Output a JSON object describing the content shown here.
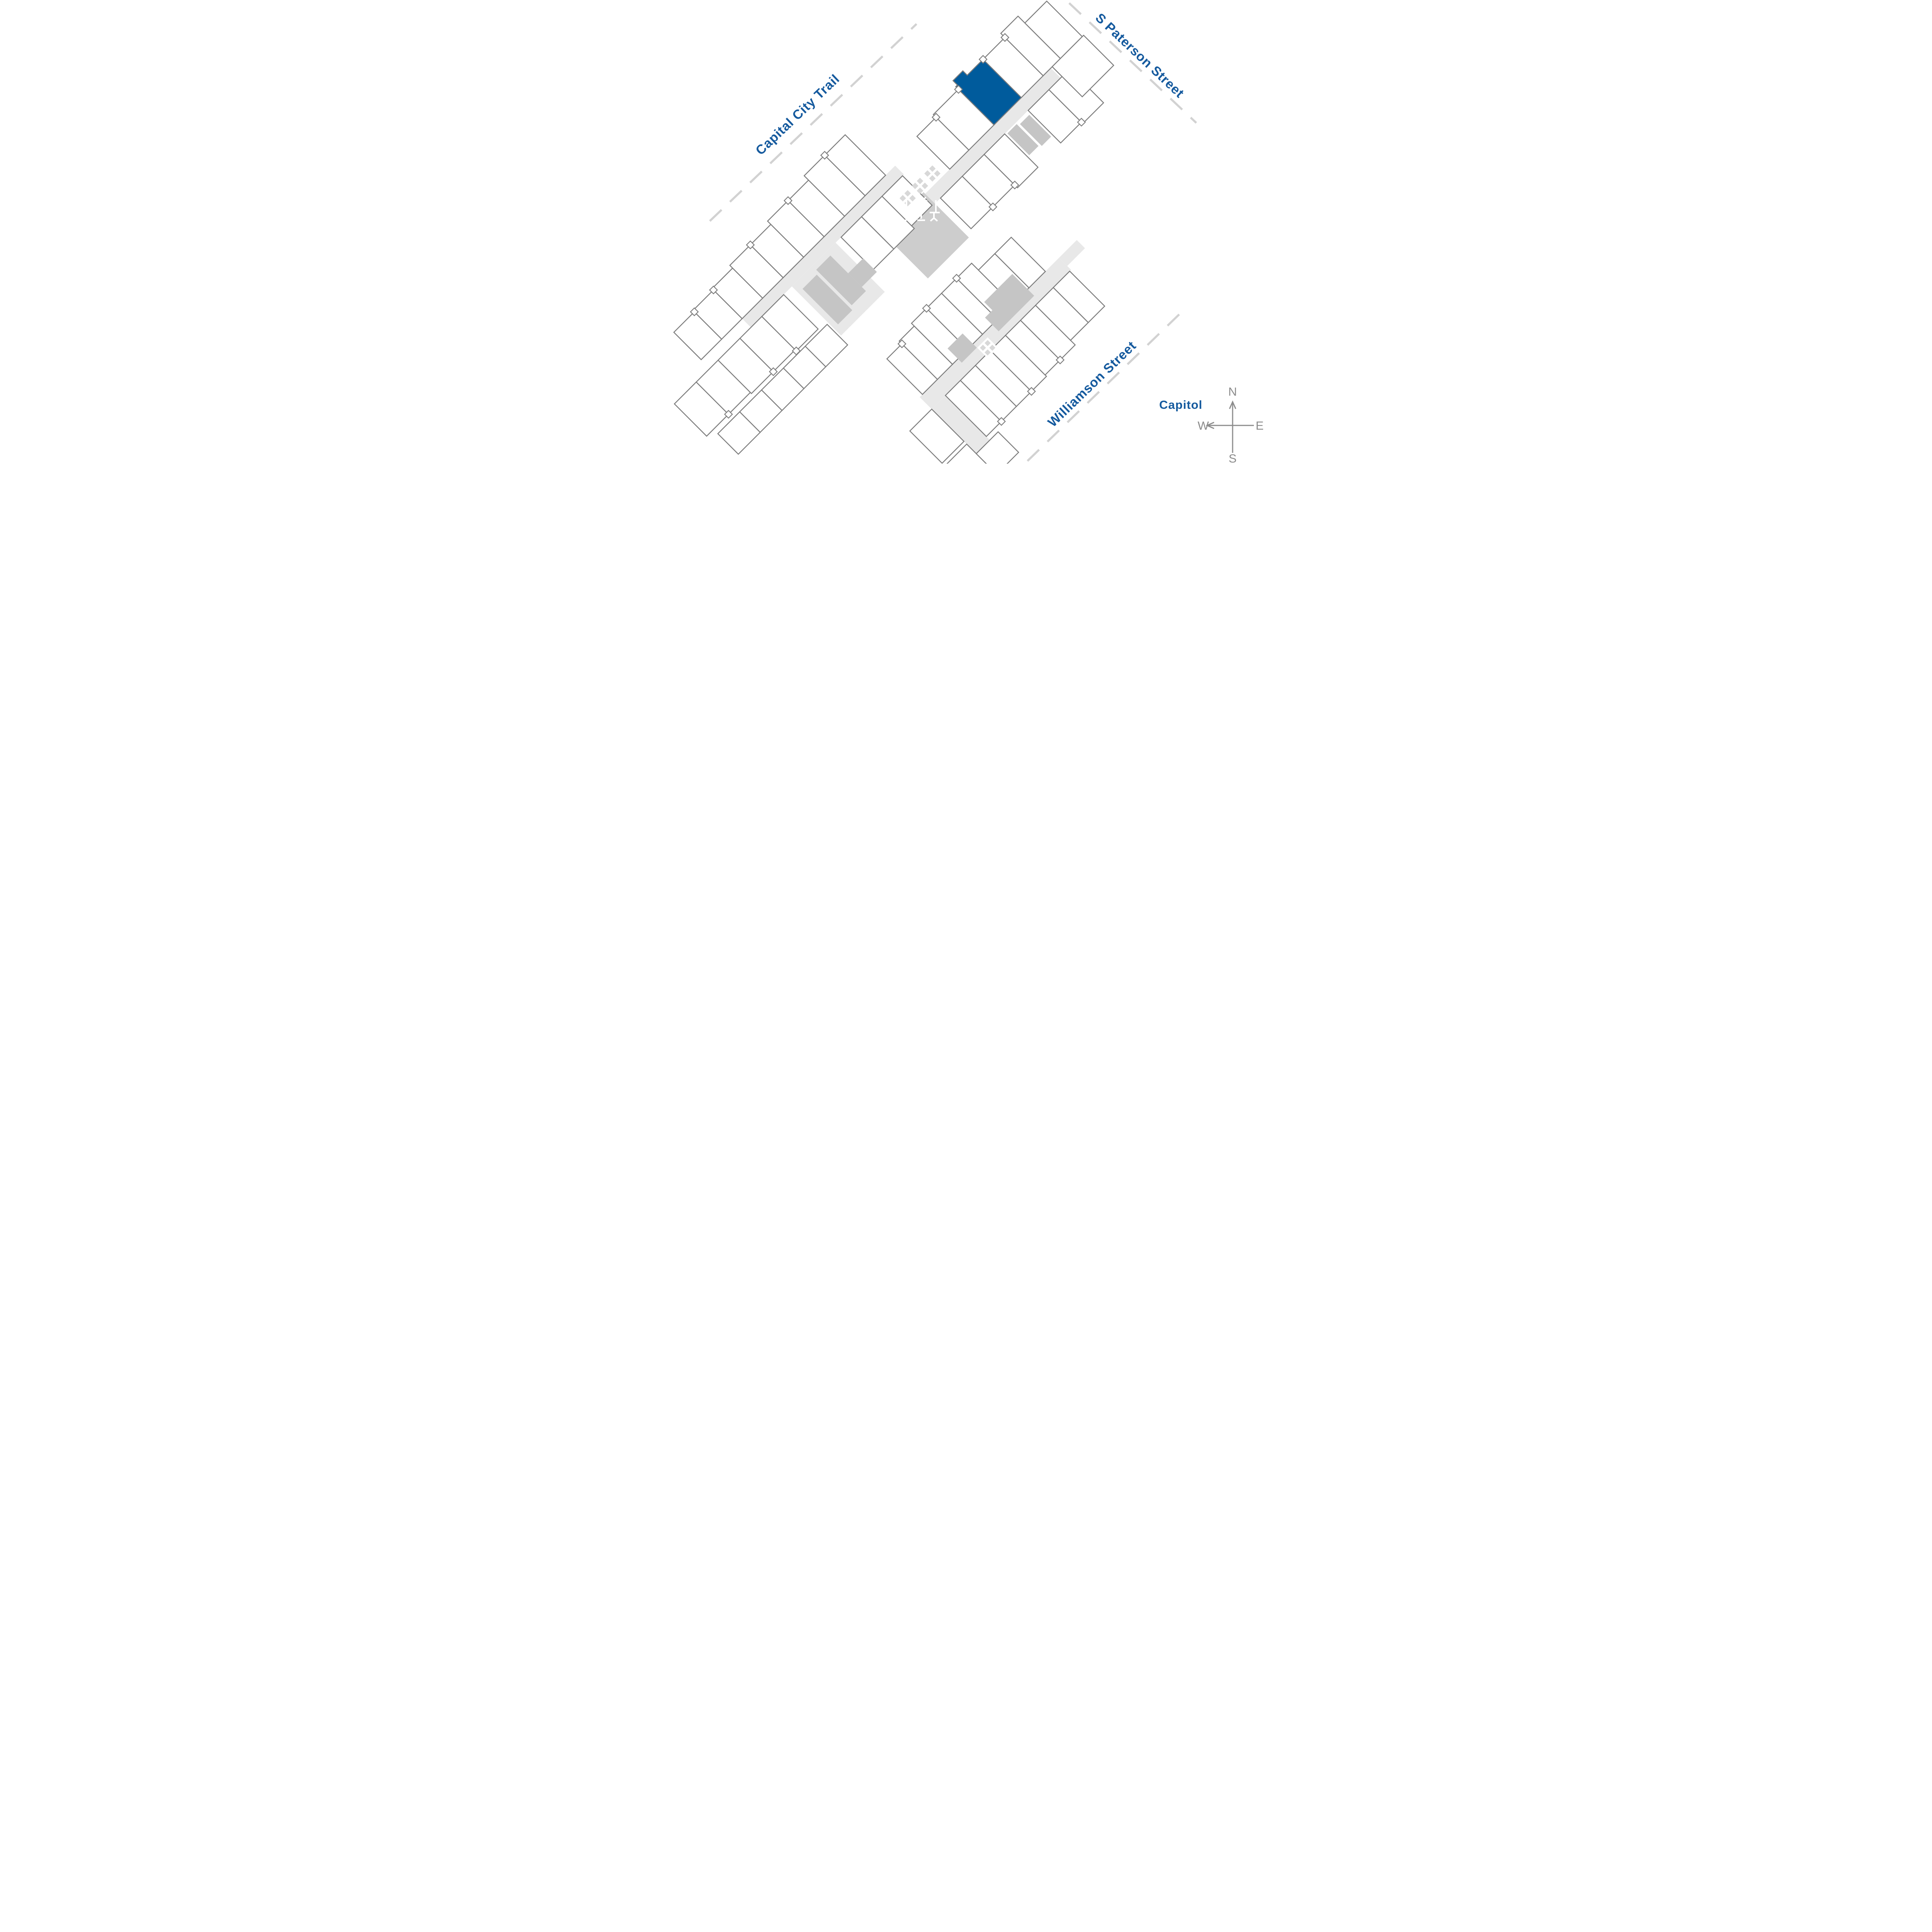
{
  "map": {
    "streets": {
      "capital_city_trail": "Capital City Trail",
      "s_paterson": "S Paterson Street",
      "williamson": "Williamson Street"
    },
    "landmarks": {
      "capitol": "Capitol"
    },
    "compass": {
      "north": "N",
      "south": "S",
      "east": "E",
      "west": "W"
    },
    "highlighted_unit": {
      "status": "selected"
    },
    "icons": {
      "stair": "x-stair-icon",
      "patio_table": "patio-table-icon",
      "compass": "compass-rose"
    },
    "colors": {
      "highlight": "#005B9C",
      "labelblue": "#155A9E",
      "outline": "#7C7C7C",
      "corridor": "#E8E8E8",
      "courtyard": "#CDCDCD",
      "core": "#C5C5C5",
      "dash": "#D2D2D2",
      "compassgray": "#8C8C8C"
    }
  }
}
